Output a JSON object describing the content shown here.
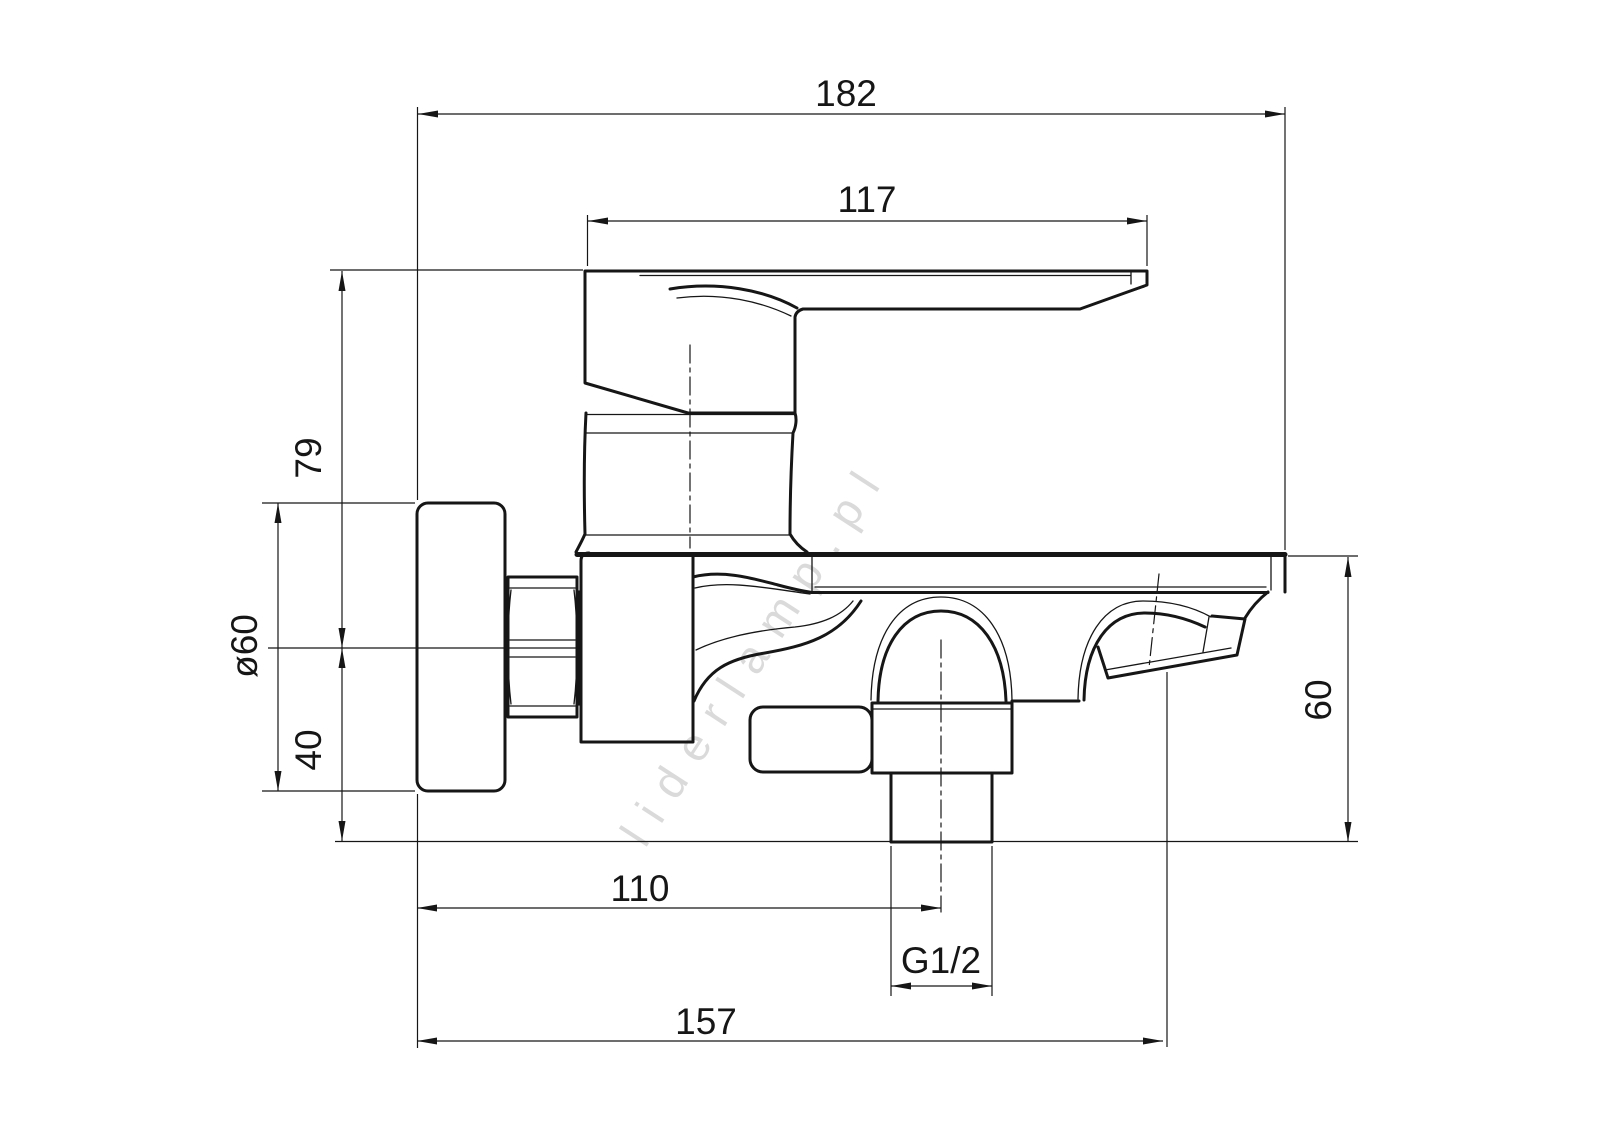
{
  "drawing": {
    "kind": "technical-dimension-drawing",
    "subject": "wall-mounted single-lever bath mixer tap, side view",
    "watermark": "liderlamp.pl",
    "colors": {
      "line": "#161616",
      "background": "#ffffff",
      "watermark": "#c3c3c3"
    },
    "dimensions": {
      "total_depth": "182",
      "handle_length": "117",
      "handle_height": "79",
      "flange_diameter": "ø60",
      "axis_to_bottom": "40",
      "spout_drop": "60",
      "wall_to_shower_outlet": "110",
      "shower_thread": "G1/2",
      "wall_to_spout_tip": "157"
    }
  }
}
